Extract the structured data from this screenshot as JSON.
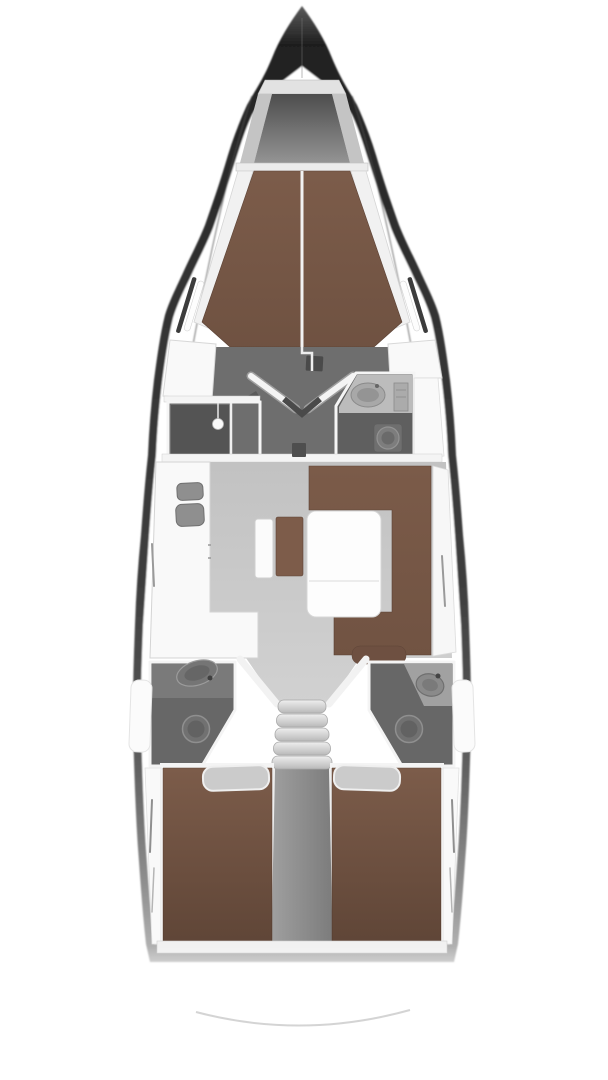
{
  "diagram": {
    "kind": "sailing-yacht-interior-floor-plan",
    "view": "top-down",
    "orientation": "bow-at-top",
    "regions": [
      {
        "id": "bow-anchor-locker"
      },
      {
        "id": "forward-cabin",
        "features": [
          "v-berth",
          "center-seam",
          "side-shelves"
        ]
      },
      {
        "id": "forward-dressing-area",
        "features": [
          "double-doors",
          "mast-step"
        ]
      },
      {
        "id": "shower-room-port",
        "features": [
          "shower-head"
        ]
      },
      {
        "id": "forward-head-starboard",
        "features": [
          "sink",
          "toilet",
          "cabinet"
        ]
      },
      {
        "id": "saloon",
        "features": [
          "folding-table",
          "center-bench",
          "u-settee"
        ]
      },
      {
        "id": "galley-port",
        "features": [
          "l-counter",
          "double-sink"
        ]
      },
      {
        "id": "companionway",
        "features": [
          "five-steps"
        ]
      },
      {
        "id": "aft-head-port",
        "features": [
          "sink",
          "toilet"
        ]
      },
      {
        "id": "aft-head-starboard",
        "features": [
          "sink",
          "toilet"
        ]
      },
      {
        "id": "aft-cabin-port",
        "features": [
          "double-berth",
          "pillow",
          "side-locker"
        ]
      },
      {
        "id": "aft-cabin-starboard",
        "features": [
          "double-berth",
          "pillow",
          "side-locker"
        ]
      },
      {
        "id": "engine-compartment-centerline"
      },
      {
        "id": "stern-transom"
      }
    ]
  },
  "colors": {
    "background": "#ffffff",
    "hull_dark": "#2f2f2f",
    "wall_white": "#f4f4f4",
    "furniture_white": "#f9f9f9",
    "berth_brown": "#7c5c4a",
    "settee_brown": "#7b5b49",
    "cushion_brown": "#6e5041",
    "bench_brown": "#7d5c4a",
    "floor_dark": "#6e6e6e",
    "floor_shower": "#545454",
    "floor_head": "#676767",
    "floor_salon": "#c7c7c7",
    "counter_gray": "#bcbcbc",
    "counter_head": "#8b8b8b",
    "fixture_gray": "#8f8f8f",
    "fixture_dark": "#4a4a4a",
    "pillow_gray": "#cbcbcb",
    "locker_wall_gray": "#c4c4c4",
    "shelf_white": "#ececec",
    "engine_box_gray": "#8f8f8f",
    "slit_gray": "#9a9a9a"
  }
}
